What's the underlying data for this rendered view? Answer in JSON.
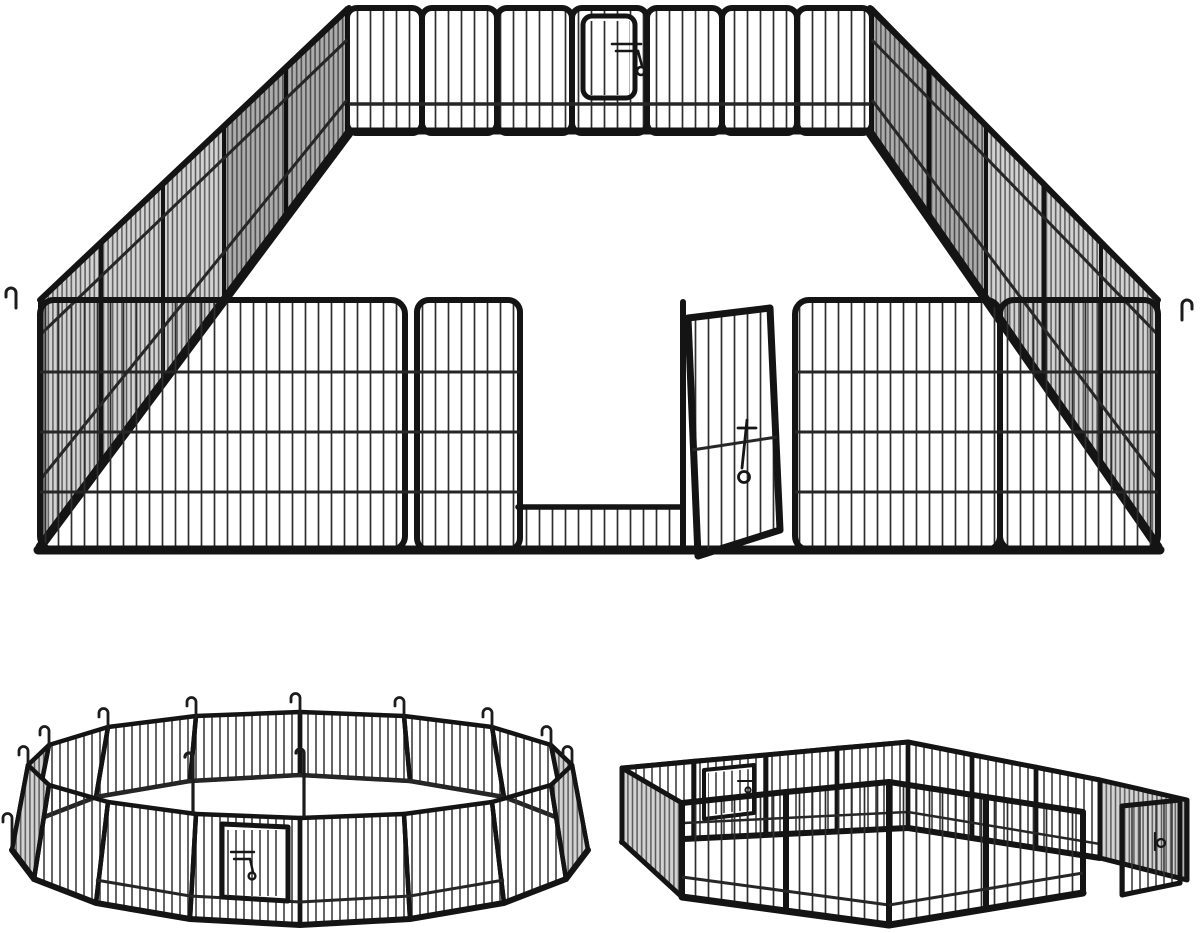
{
  "meta": {
    "type": "product-photo",
    "image_alt": "Heavy-duty black metal pet playpen exercise fence shown in three arrangements on a white background",
    "text_visible": "none"
  },
  "palette": {
    "background": "#ffffff",
    "frame": "#111111",
    "bar": "#2e2e2e",
    "bar_soft": "#555555",
    "dense_panel_fill": "#d2d2d2"
  },
  "configurations": [
    {
      "id": "rectangular-pen",
      "label": "Large rectangular playpen in perspective with arched wire panels, rear gate with latch, and front gate door swung open",
      "position": "top",
      "gates": 2,
      "features": [
        "arched-top panels",
        "vertical wire bars",
        "gate latch",
        "open front door",
        "corner ground hooks"
      ]
    },
    {
      "id": "circular-pen",
      "label": "Panels arranged in a circle with a latched gate door and J-shaped ground stakes rising at the panel joints",
      "position": "bottom-left",
      "gates": 1,
      "features": [
        "16 panels in a ring",
        "ground stake hooks",
        "gate with latch",
        "tall anchor pins at front"
      ]
    },
    {
      "id": "l-shaped-pen",
      "label": "Panels arranged as two rectangular rooms joined in an L shape with a rear gate and an open doorway on the right room",
      "position": "bottom-right",
      "gates": 2,
      "features": [
        "two rooms joined at a corner",
        "rear gate with latch",
        "open side doorway with door"
      ]
    }
  ],
  "icons": {
    "gate_latch": "gate-latch-icon",
    "ground_hook": "ground-stake-hook-icon",
    "anchor_pin": "anchor-pin-icon"
  }
}
